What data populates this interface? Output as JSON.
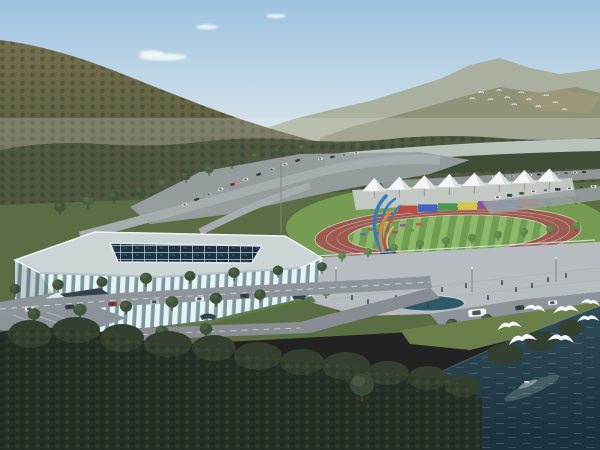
{
  "scene": {
    "name": "aerial-architectural-rendering-sports-complex",
    "colors": {
      "skyTop": "#9cc2e2",
      "skyMid": "#cbdde8",
      "skyHor": "#e9eeec",
      "cloud": "#f5f9fa",
      "haze": "#eaeeec",
      "mtnFar": "#a9ae9b",
      "mtnFar2": "#8f9379",
      "scree": "#a89a7c",
      "mtnTop": "#74704e",
      "mtnBot": "#4e5239",
      "treeband": "#4e5840",
      "treebandDark": "#404d36",
      "river": "#b8c3bb",
      "riverEdge": "#dfe6e2",
      "ground": "#5b6d44",
      "lawn": "#79a156",
      "grassLight": "#6a7f4a",
      "parking": "#99a0a2",
      "roadMid": "#a6adaf",
      "roadFore": "#8e959a",
      "roadFore2": "#878d92",
      "roadLine": "#d8dde0",
      "plaza": "#b6bcbf",
      "plazaLine": "#a9b0b3",
      "pool": "#2c5a68",
      "fence": "#e3e8ea",
      "roofPlate": "#ccd5d5",
      "arenaRim": "#e9eff2",
      "ribs": "#ebf1f3",
      "glass": "#6f9aa0",
      "roofDark": "#1e3242",
      "roofGrid": "#bfd2dc",
      "shadow": "#26323a",
      "stairs": "#8b9298",
      "stairWall": "#e2e7ea",
      "canopy": "#33424c",
      "berm": "#55713f",
      "track": "#9d5a50",
      "trackLine": "#d6cec4",
      "fieldA": "#8fb96a",
      "fieldB": "#6f9e52",
      "stand": "#c7cbc8",
      "tentW": "#f3f5f6",
      "tentS": "#d9dee1",
      "pole": "#7d868c",
      "sculpBlue": "#2f7fc4",
      "sculpOrange": "#e2852f",
      "sculpRed": "#c94f35",
      "sculpYellow": "#e8c24a",
      "sculpBase": "#2e4468",
      "plinth": "#9aa2a6",
      "waterHi": "#33525f",
      "waterLo": "#1c333d",
      "ripple": "#cfe0e4",
      "reflect": "#dfe9ea",
      "folFore": "#232e24",
      "folBump": "#33402f",
      "treeMid": "#415539",
      "treeDark": "#3c5036",
      "treeLight": "#5f8549",
      "treeSingle": "#3a4a36",
      "trunk": "#4a3f30",
      "bird": "#f6fafb",
      "people": "#3a4148",
      "carWin": "#2c3742"
    },
    "clouds": [
      {
        "cx": 163,
        "cy": 57,
        "rx": 24,
        "ry": 3.5
      },
      {
        "cx": 151,
        "cy": 53,
        "rx": 12,
        "ry": 2.6
      },
      {
        "cx": 207,
        "cy": 27,
        "rx": 11,
        "ry": 2.2
      },
      {
        "cx": 276,
        "cy": 16,
        "rx": 10,
        "ry": 2
      }
    ],
    "far_birds": [
      {
        "transform": "translate(470,98) scale(0.4)"
      },
      {
        "transform": "translate(479,92) scale(0.38)"
      },
      {
        "transform": "translate(488,99) scale(0.42)"
      },
      {
        "transform": "translate(497,90) scale(0.36)"
      },
      {
        "transform": "translate(505,97) scale(0.4)"
      },
      {
        "transform": "translate(512,104) scale(0.38)"
      },
      {
        "transform": "translate(519,92) scale(0.4)"
      },
      {
        "transform": "translate(527,99) scale(0.36)"
      },
      {
        "transform": "translate(536,106) scale(0.42)"
      },
      {
        "transform": "translate(544,95) scale(0.38)"
      },
      {
        "transform": "translate(553,102) scale(0.4)"
      },
      {
        "transform": "translate(562,109) scale(0.36)"
      }
    ],
    "gulls": [
      {
        "transform": "translate(497,326) rotate(-8) scale(1.1)"
      },
      {
        "transform": "translate(524,306) rotate(6) scale(1.0)"
      },
      {
        "transform": "translate(553,309) rotate(-4) scale(1.15)"
      },
      {
        "transform": "translate(581,300) rotate(8) scale(0.9)"
      },
      {
        "transform": "translate(508,340) rotate(-10) scale(1.3)"
      },
      {
        "transform": "translate(548,336) rotate(5) scale(1.2)"
      },
      {
        "transform": "translate(577,318) rotate(-3) scale(1.0)"
      }
    ],
    "tents": [
      {
        "transform": "translate(362,178) scale(0.95)"
      },
      {
        "transform": "translate(387,176.6) scale(0.95)"
      },
      {
        "transform": "translate(412,175.3) scale(0.95)"
      },
      {
        "transform": "translate(437,173.9) scale(0.95)"
      },
      {
        "transform": "translate(462,172.6) scale(0.95)"
      },
      {
        "transform": "translate(487,171.2) scale(0.95)"
      },
      {
        "transform": "translate(512,169.9) scale(0.95)"
      },
      {
        "transform": "translate(537,168.5) scale(0.95)"
      }
    ],
    "ad_boards": [
      {
        "x": 398,
        "y": 205.5,
        "fill": "#bf4a40"
      },
      {
        "x": 418,
        "y": 204.4,
        "fill": "#4663c4"
      },
      {
        "x": 438,
        "y": 203.3,
        "fill": "#4a9a4f"
      },
      {
        "x": 458,
        "y": 202.2,
        "fill": "#d2c74b"
      },
      {
        "x": 478,
        "y": 201.1,
        "fill": "#8a52ad"
      },
      {
        "x": 498,
        "y": 200.0,
        "fill": "#4a72c8"
      },
      {
        "x": 518,
        "y": 198.9,
        "fill": "#bf4a40"
      }
    ],
    "field_patches": [
      {
        "x": 368,
        "y": 228,
        "fill": "#b85048"
      },
      {
        "x": 376,
        "y": 232,
        "fill": "#4a68c0"
      },
      {
        "x": 384,
        "y": 226,
        "fill": "#c8b84a"
      },
      {
        "x": 392,
        "y": 231,
        "fill": "#b85048"
      },
      {
        "x": 400,
        "y": 224,
        "fill": "#8a52a8"
      },
      {
        "x": 408,
        "y": 229,
        "fill": "#4a9a50"
      },
      {
        "x": 416,
        "y": 223,
        "fill": "#b85048"
      },
      {
        "x": 360,
        "y": 233,
        "fill": "#4a68c0"
      }
    ],
    "mid_trees": [
      {
        "transform": "translate(140,198) scale(1.0)",
        "fill": "#415539"
      },
      {
        "transform": "translate(163,190) scale(0.9)",
        "fill": "#4a6040"
      },
      {
        "transform": "translate(186,182) scale(0.85)",
        "fill": "#415539"
      },
      {
        "transform": "translate(209,175) scale(0.8)",
        "fill": "#4a6040"
      },
      {
        "transform": "translate(232,168) scale(0.75)",
        "fill": "#415539"
      },
      {
        "transform": "translate(255,161) scale(0.7)",
        "fill": "#4a6040"
      },
      {
        "transform": "translate(278,156) scale(0.7)",
        "fill": "#415539"
      },
      {
        "transform": "translate(302,152) scale(0.65)",
        "fill": "#4a6040"
      },
      {
        "transform": "translate(330,149) scale(0.6)",
        "fill": "#415539"
      },
      {
        "transform": "translate(358,150) scale(0.6)",
        "fill": "#4a6040"
      },
      {
        "transform": "translate(60,214) scale(1.05)",
        "fill": "#415539"
      },
      {
        "transform": "translate(88,208) scale(1.0)",
        "fill": "#4a6040"
      },
      {
        "transform": "translate(114,203) scale(1.0)",
        "fill": "#415539"
      },
      {
        "transform": "translate(494,213) scale(0.7)",
        "fill": "#4a6040"
      },
      {
        "transform": "translate(520,210) scale(0.7)",
        "fill": "#415539"
      },
      {
        "transform": "translate(548,207) scale(0.7)",
        "fill": "#4a6040"
      },
      {
        "transform": "translate(576,204) scale(0.7)",
        "fill": "#415539"
      }
    ],
    "road_trees": [
      {
        "transform": "translate(15,296) scale(1.0)",
        "fill": "#3c5036"
      },
      {
        "transform": "translate(58,292) scale(1.05)",
        "fill": "#415539"
      },
      {
        "transform": "translate(102,289) scale(1.0)",
        "fill": "#3c5036"
      },
      {
        "transform": "translate(146,286) scale(1.1)",
        "fill": "#415539"
      },
      {
        "transform": "translate(190,283) scale(1.0)",
        "fill": "#3c5036"
      },
      {
        "transform": "translate(234,280) scale(1.05)",
        "fill": "#415539"
      },
      {
        "transform": "translate(278,277) scale(0.95)",
        "fill": "#3c5036"
      },
      {
        "transform": "translate(322,273) scale(0.9)",
        "fill": "#415539"
      },
      {
        "transform": "translate(34,322) scale(1.15)",
        "fill": "#3c5036"
      },
      {
        "transform": "translate(80,318) scale(1.2)",
        "fill": "#415539"
      },
      {
        "transform": "translate(126,314) scale(1.1)",
        "fill": "#3c5036"
      },
      {
        "transform": "translate(172,310) scale(1.15)",
        "fill": "#415539"
      },
      {
        "transform": "translate(216,306) scale(1.1)",
        "fill": "#3c5036"
      },
      {
        "transform": "translate(260,302) scale(1.05)",
        "fill": "#415539"
      },
      {
        "transform": "translate(24,352) scale(1.25)",
        "fill": "#3c5036"
      },
      {
        "transform": "translate(70,348) scale(1.2)",
        "fill": "#415539"
      },
      {
        "transform": "translate(116,344) scale(1.25)",
        "fill": "#3c5036"
      },
      {
        "transform": "translate(162,340) scale(1.2)",
        "fill": "#415539"
      },
      {
        "transform": "translate(206,337) scale(1.15)",
        "fill": "#3c5036"
      },
      {
        "transform": "translate(452,332) scale(1.1)",
        "fill": "#3c5036"
      },
      {
        "transform": "translate(487,326) scale(1.0)",
        "fill": "#415539"
      }
    ],
    "plaza_trees": [
      {
        "transform": "translate(316,266) scale(0.75)",
        "fill": "#5f8549"
      },
      {
        "transform": "translate(342,261) scale(0.75)",
        "fill": "#5f8549"
      },
      {
        "transform": "translate(368,257) scale(0.75)",
        "fill": "#5f8549"
      },
      {
        "transform": "translate(394,253) scale(0.75)",
        "fill": "#5f8549"
      },
      {
        "transform": "translate(420,249) scale(0.75)",
        "fill": "#5f8549"
      },
      {
        "transform": "translate(446,246) scale(0.75)",
        "fill": "#5f8549"
      },
      {
        "transform": "translate(472,243) scale(0.75)",
        "fill": "#5f8549"
      },
      {
        "transform": "translate(498,240) scale(0.75)",
        "fill": "#5f8549"
      },
      {
        "transform": "translate(524,237) scale(0.75)",
        "fill": "#5f8549"
      },
      {
        "transform": "translate(550,234) scale(0.75)",
        "fill": "#5f8549"
      },
      {
        "transform": "translate(576,231) scale(0.75)",
        "fill": "#5f8549"
      },
      {
        "transform": "translate(352,292) scale(0.9)",
        "fill": "#5f8549"
      },
      {
        "transform": "translate(326,298) scale(0.9)",
        "fill": "#5f8549"
      }
    ],
    "people": [
      {
        "transform": "translate(352,300)"
      },
      {
        "transform": "translate(368,304)"
      },
      {
        "transform": "translate(396,300)"
      },
      {
        "transform": "translate(418,296)"
      },
      {
        "transform": "translate(442,292)"
      },
      {
        "transform": "translate(466,288)"
      },
      {
        "transform": "translate(488,300)"
      },
      {
        "transform": "translate(502,285)"
      },
      {
        "transform": "translate(516,292)"
      },
      {
        "transform": "translate(532,288)"
      },
      {
        "transform": "translate(548,282)"
      },
      {
        "transform": "translate(566,278)"
      },
      {
        "transform": "translate(372,312)"
      },
      {
        "transform": "translate(428,308)"
      },
      {
        "transform": "translate(338,316)"
      },
      {
        "transform": "translate(300,280)"
      },
      {
        "transform": "translate(254,300)"
      },
      {
        "transform": "translate(212,312)"
      }
    ],
    "cars_fore": [
      {
        "transform": "translate(25,307) rotate(-4)",
        "fill": "#e9ebec"
      },
      {
        "transform": "translate(65,305) rotate(-4)",
        "fill": "#39444f"
      },
      {
        "transform": "translate(108,302) rotate(-4)",
        "fill": "#a23a32"
      },
      {
        "transform": "translate(150,300) rotate(-4)",
        "fill": "#b9bfc4"
      },
      {
        "transform": "translate(195,297) rotate(-4)",
        "fill": "#e9ebec"
      },
      {
        "transform": "translate(240,294) rotate(-4)",
        "fill": "#39444f"
      },
      {
        "transform": "translate(10,346) rotate(-4)",
        "fill": "#e9ebec"
      },
      {
        "transform": "translate(50,344) rotate(-4)",
        "fill": "#39444f"
      },
      {
        "transform": "translate(95,341) rotate(-4)",
        "fill": "#a23a32"
      },
      {
        "transform": "translate(515,306) rotate(-6)",
        "fill": "#39444f"
      },
      {
        "transform": "translate(548,301) rotate(-6)",
        "fill": "#e9ebec"
      }
    ],
    "cars_mid": [
      {
        "transform": "translate(182,204) rotate(-18) scale(0.55)",
        "fill": "#e9ebec"
      },
      {
        "transform": "translate(194,199) rotate(-18) scale(0.55)",
        "fill": "#39444f"
      },
      {
        "transform": "translate(206,194) rotate(-18) scale(0.55)",
        "fill": "#b9bfc4"
      },
      {
        "transform": "translate(218,189) rotate(-18) scale(0.55)",
        "fill": "#e9ebec"
      },
      {
        "transform": "translate(230,184) rotate(-18) scale(0.55)",
        "fill": "#a23a32"
      },
      {
        "transform": "translate(243,179) rotate(-18) scale(0.55)",
        "fill": "#e9ebec"
      },
      {
        "transform": "translate(256,174) rotate(-18) scale(0.55)",
        "fill": "#39444f"
      },
      {
        "transform": "translate(269,169) rotate(-18) scale(0.55)",
        "fill": "#b9bfc4"
      },
      {
        "transform": "translate(282,164) rotate(-18) scale(0.55)",
        "fill": "#e9ebec"
      },
      {
        "transform": "translate(295,160) rotate(-18) scale(0.55)",
        "fill": "#39444f"
      },
      {
        "transform": "translate(318,158) rotate(-5) scale(0.5)",
        "fill": "#e9ebec"
      },
      {
        "transform": "translate(330,156) rotate(-5) scale(0.5)",
        "fill": "#39444f"
      },
      {
        "transform": "translate(342,154) rotate(-5) scale(0.5)",
        "fill": "#b9bfc4"
      },
      {
        "transform": "translate(354,152) rotate(-5) scale(0.5)",
        "fill": "#e9ebec"
      }
    ],
    "cars_far": [
      {
        "transform": "translate(492,176) scale(0.45)",
        "fill": "#e9ebec"
      },
      {
        "transform": "translate(501,175.5) scale(0.45)",
        "fill": "#39444f"
      },
      {
        "transform": "translate(510,175) scale(0.45)",
        "fill": "#b9bfc4"
      },
      {
        "transform": "translate(519,174.5) scale(0.45)",
        "fill": "#5a7a5a"
      },
      {
        "transform": "translate(528,174) scale(0.45)",
        "fill": "#e9ebec"
      },
      {
        "transform": "translate(537,173.5) scale(0.45)",
        "fill": "#39444f"
      },
      {
        "transform": "translate(546,173) scale(0.45)",
        "fill": "#e9ebec"
      },
      {
        "transform": "translate(555,172.5) scale(0.45)",
        "fill": "#b9bfc4"
      },
      {
        "transform": "translate(564,172) scale(0.45)",
        "fill": "#5a7a5a"
      },
      {
        "transform": "translate(573,171.5) scale(0.45)",
        "fill": "#e9ebec"
      },
      {
        "transform": "translate(582,171) scale(0.45)",
        "fill": "#39444f"
      }
    ],
    "cars_right": [
      {
        "transform": "translate(495,196) scale(0.6)",
        "fill": "#e9ebec"
      },
      {
        "transform": "translate(507,194) scale(0.6)",
        "fill": "#39444f"
      },
      {
        "transform": "translate(519,192) scale(0.6)",
        "fill": "#5a7a5a"
      },
      {
        "transform": "translate(531,190) scale(0.6)",
        "fill": "#e9ebec"
      },
      {
        "transform": "translate(543,189) scale(0.6)",
        "fill": "#b9bfc4"
      },
      {
        "transform": "translate(555,188) scale(0.6)",
        "fill": "#39444f"
      },
      {
        "transform": "translate(567,187) scale(0.6)",
        "fill": "#e9ebec"
      },
      {
        "transform": "translate(579,186) scale(0.6)",
        "fill": "#5a7a5a"
      },
      {
        "transform": "translate(591,185) scale(0.6)",
        "fill": "#e9ebec"
      }
    ],
    "fore_bumps": [
      {
        "cx": 30,
        "cy": 334,
        "rx": 22,
        "ry": 14
      },
      {
        "cx": 76,
        "cy": 330,
        "rx": 24,
        "ry": 13
      },
      {
        "cx": 122,
        "cy": 338,
        "rx": 22,
        "ry": 14
      },
      {
        "cx": 168,
        "cy": 344,
        "rx": 24,
        "ry": 13
      },
      {
        "cx": 214,
        "cy": 348,
        "rx": 22,
        "ry": 13
      },
      {
        "cx": 258,
        "cy": 356,
        "rx": 24,
        "ry": 14
      },
      {
        "cx": 302,
        "cy": 362,
        "rx": 22,
        "ry": 13
      },
      {
        "cx": 346,
        "cy": 366,
        "rx": 24,
        "ry": 14
      },
      {
        "cx": 388,
        "cy": 373,
        "rx": 21,
        "ry": 12
      },
      {
        "cx": 428,
        "cy": 378,
        "rx": 20,
        "ry": 12
      },
      {
        "cx": 463,
        "cy": 386,
        "rx": 18,
        "ry": 11
      },
      {
        "cx": 505,
        "cy": 354,
        "rx": 18,
        "ry": 11
      },
      {
        "cx": 540,
        "cy": 341,
        "rx": 16,
        "ry": 10
      },
      {
        "cx": 571,
        "cy": 328,
        "rx": 13,
        "ry": 8
      }
    ]
  }
}
